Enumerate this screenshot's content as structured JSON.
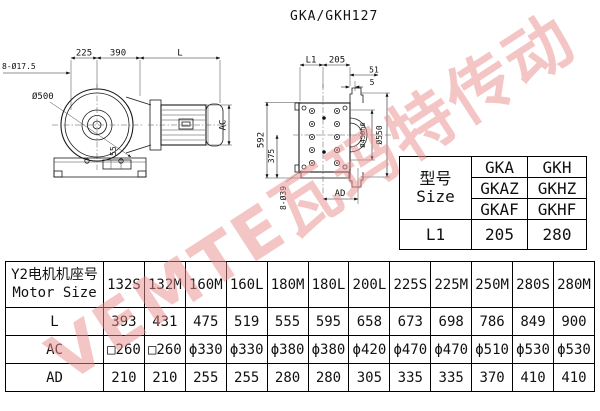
{
  "title": "GKA/GKH127",
  "watermark": "VEMTE瓦玛特传动",
  "left_drawing": {
    "dims": {
      "bolt_holes": "8-Ø17.5",
      "dim_225": "225",
      "dim_390": "390",
      "dim_L": "L",
      "diameter": "Ø500",
      "shaft": "55",
      "height_ac": "AC"
    }
  },
  "right_drawing": {
    "dims": {
      "dim_L1": "L1",
      "dim_205": "205",
      "dim_51": "51",
      "dim_5": "5",
      "height_592": "592",
      "height_375": "375",
      "bolt_holes": "8-Ø39",
      "width_ad": "AD",
      "hub": "Ø450h6",
      "flange": "Ø550"
    }
  },
  "size_table": {
    "header_cn": "型号",
    "header_en": "Size",
    "variants": [
      [
        "GKA",
        "GKH"
      ],
      [
        "GKAZ",
        "GKHZ"
      ],
      [
        "GKAF",
        "GKHF"
      ]
    ],
    "l1_label": "L1",
    "l1_values": [
      "205",
      "280"
    ]
  },
  "motor_table": {
    "header_cn": "Y2电机机座号",
    "header_en": "Motor Size",
    "sizes": [
      "132S",
      "132M",
      "160M",
      "160L",
      "180M",
      "180L",
      "200L",
      "225S",
      "225M",
      "250M",
      "280S",
      "280M"
    ],
    "rows": [
      {
        "label": "L",
        "values": [
          "393",
          "431",
          "475",
          "519",
          "555",
          "595",
          "658",
          "673",
          "698",
          "786",
          "849",
          "900"
        ]
      },
      {
        "label": "AC",
        "values": [
          "□260",
          "□260",
          "ϕ330",
          "ϕ330",
          "ϕ380",
          "ϕ380",
          "ϕ420",
          "ϕ470",
          "ϕ470",
          "ϕ510",
          "ϕ530",
          "ϕ530"
        ]
      },
      {
        "label": "AD",
        "values": [
          "210",
          "210",
          "255",
          "255",
          "280",
          "280",
          "305",
          "335",
          "335",
          "370",
          "410",
          "410"
        ]
      }
    ]
  }
}
